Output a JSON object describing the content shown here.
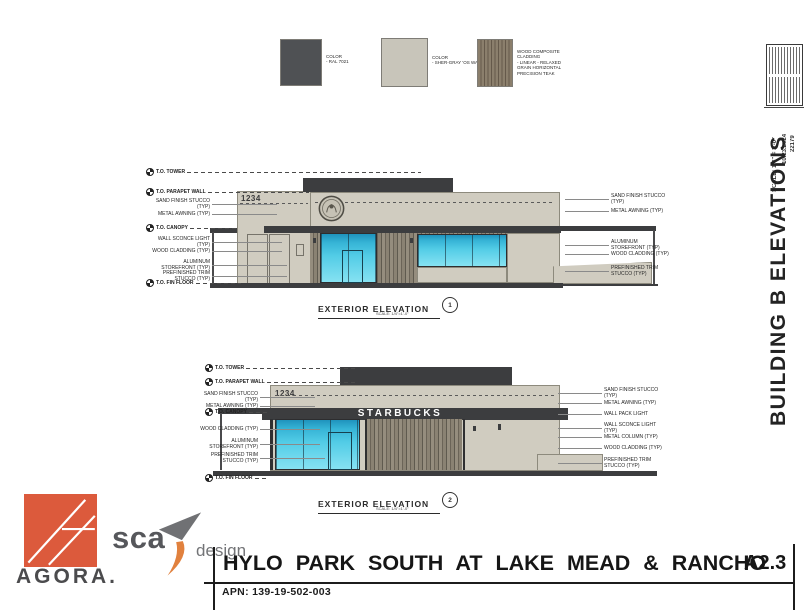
{
  "sheet": {
    "side_title": "BUILDING B ELEVATIONS",
    "scale_note": "SCALE: 1/4\" = 1'-0\"",
    "date": "10.23.2024",
    "job_number": "22179"
  },
  "materials": {
    "paint_dark": {
      "color": "#4f5154",
      "lines": [
        "COLOR",
        "- RAL 7021"
      ]
    },
    "paint_light": {
      "color": "#c8c5ba",
      "lines": [
        "COLOR",
        "- SHER-GRAY 'OS WAD'"
      ]
    },
    "wood": {
      "lines": [
        "WOOD COMPOSITE",
        "CLADDING",
        "- LINEAR - RELAXED",
        "GRAIN HORIZONTAL",
        "PRECISION TEAK"
      ]
    }
  },
  "elev1": {
    "building_number": "1234",
    "title": "EXTERIOR ELEVATION",
    "scale": "SCALE: 1/4\"=1'-0\"",
    "detail": "1",
    "levels": [
      "T.O. TOWER",
      "T.O. PARAPET WALL",
      "T.O. CANOPY",
      "T.O. FIN FLOOR"
    ],
    "notes_left": [
      "SAND FINISH STUCCO (TYP)",
      "METAL AWNING (TYP)",
      "WALL SCONCE LIGHT (TYP)",
      "WOOD CLADDING (TYP)",
      "ALUMINUM STOREFRONT (TYP)",
      "PREFINISHED TRIM STUCCO (TYP)"
    ],
    "notes_right": [
      "SAND FINISH STUCCO (TYP)",
      "METAL AWNING (TYP)",
      "ALUMINUM STOREFRONT (TYP)",
      "WOOD CLADDING (TYP)",
      "PREFINISHED TRIM STUCCO (TYP)"
    ]
  },
  "elev2": {
    "building_number": "1234",
    "sign": "STARBUCKS",
    "title": "EXTERIOR ELEVATION",
    "scale": "SCALE: 1/4\"=1'-0\"",
    "detail": "2",
    "levels": [
      "T.O. TOWER",
      "T.O. PARAPET WALL",
      "T.O. CANOPY",
      "T.O. FIN FLOOR"
    ],
    "notes_left": [
      "SAND FINISH STUCCO (TYP)",
      "METAL AWNING (TYP)",
      "WOOD CLADDING (TYP)",
      "ALUMINUM STOREFRONT (TYP)",
      "PREFINISHED TRIM STUCCO (TYP)"
    ],
    "notes_right": [
      "SAND FINISH STUCCO (TYP)",
      "METAL AWNING (TYP)",
      "WALL PACK LIGHT",
      "WALL SCONCE LIGHT (TYP)",
      "METAL COLUMN (TYP)",
      "WOOD CLADDING (TYP)",
      "PREFINISHED TRIM STUCCO (TYP)"
    ]
  },
  "title_block": {
    "project": "HYLO PARK SOUTH AT LAKE MEAD & RANCHO",
    "apn": "APN: 139-19-502-003",
    "sheet_number": "A2.3"
  },
  "branding": {
    "agora": "AGORA.",
    "sca": "sca",
    "design": "design"
  }
}
